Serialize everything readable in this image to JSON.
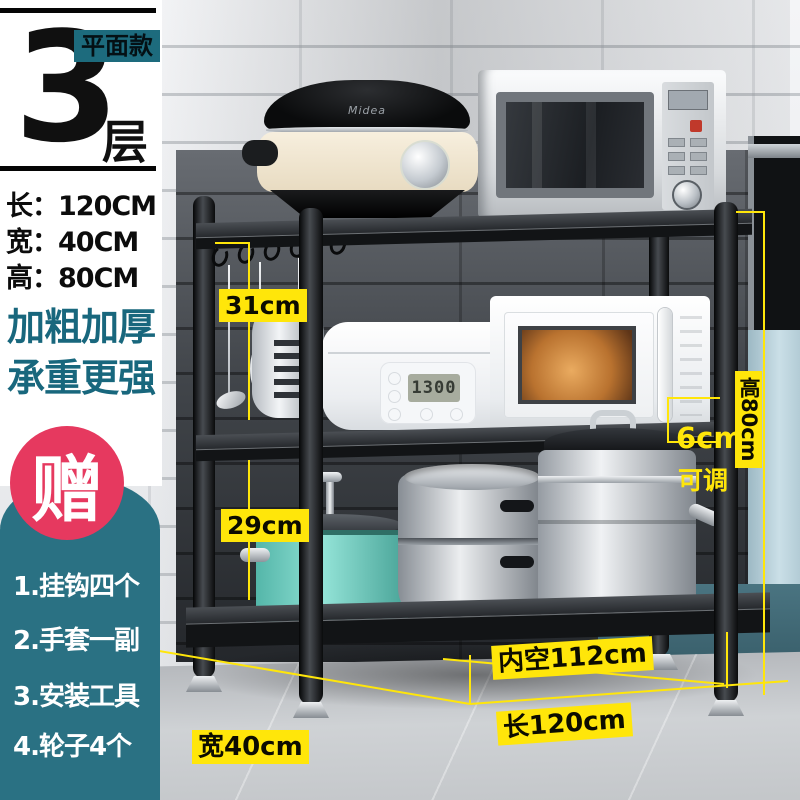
{
  "badge": {
    "tiers_number": "3",
    "tiers_unit": "层",
    "style_tag": "平面款"
  },
  "dims": {
    "rows": [
      "长：120CM",
      "宽：40CM",
      "高：80CM"
    ]
  },
  "slogan": {
    "line1": "加粗加厚",
    "line2": "承重更强"
  },
  "gift": {
    "title": "赠",
    "items": [
      "1.挂钩四个",
      "2.手套一副",
      "3.安装工具",
      "4.轮子4个"
    ]
  },
  "annotations": {
    "gap_top": "31cm",
    "gap_bottom": "29cm",
    "height": "高80cm",
    "adjust_value": "6cm",
    "adjust_note": "可调",
    "inner_width": "内空112cm",
    "length": "长120cm",
    "depth": "宽40cm"
  },
  "appliances": {
    "rice_cooker_brand": "Midea",
    "rice_cooker_display": "1300"
  },
  "colors": {
    "teal_text": "#18677d",
    "teal_badge": "#1d6b7d",
    "teal_panel": "#2a7183",
    "pink": "#e6395f",
    "annotation_yellow": "#ffe60a",
    "rack_black": "#121416"
  }
}
